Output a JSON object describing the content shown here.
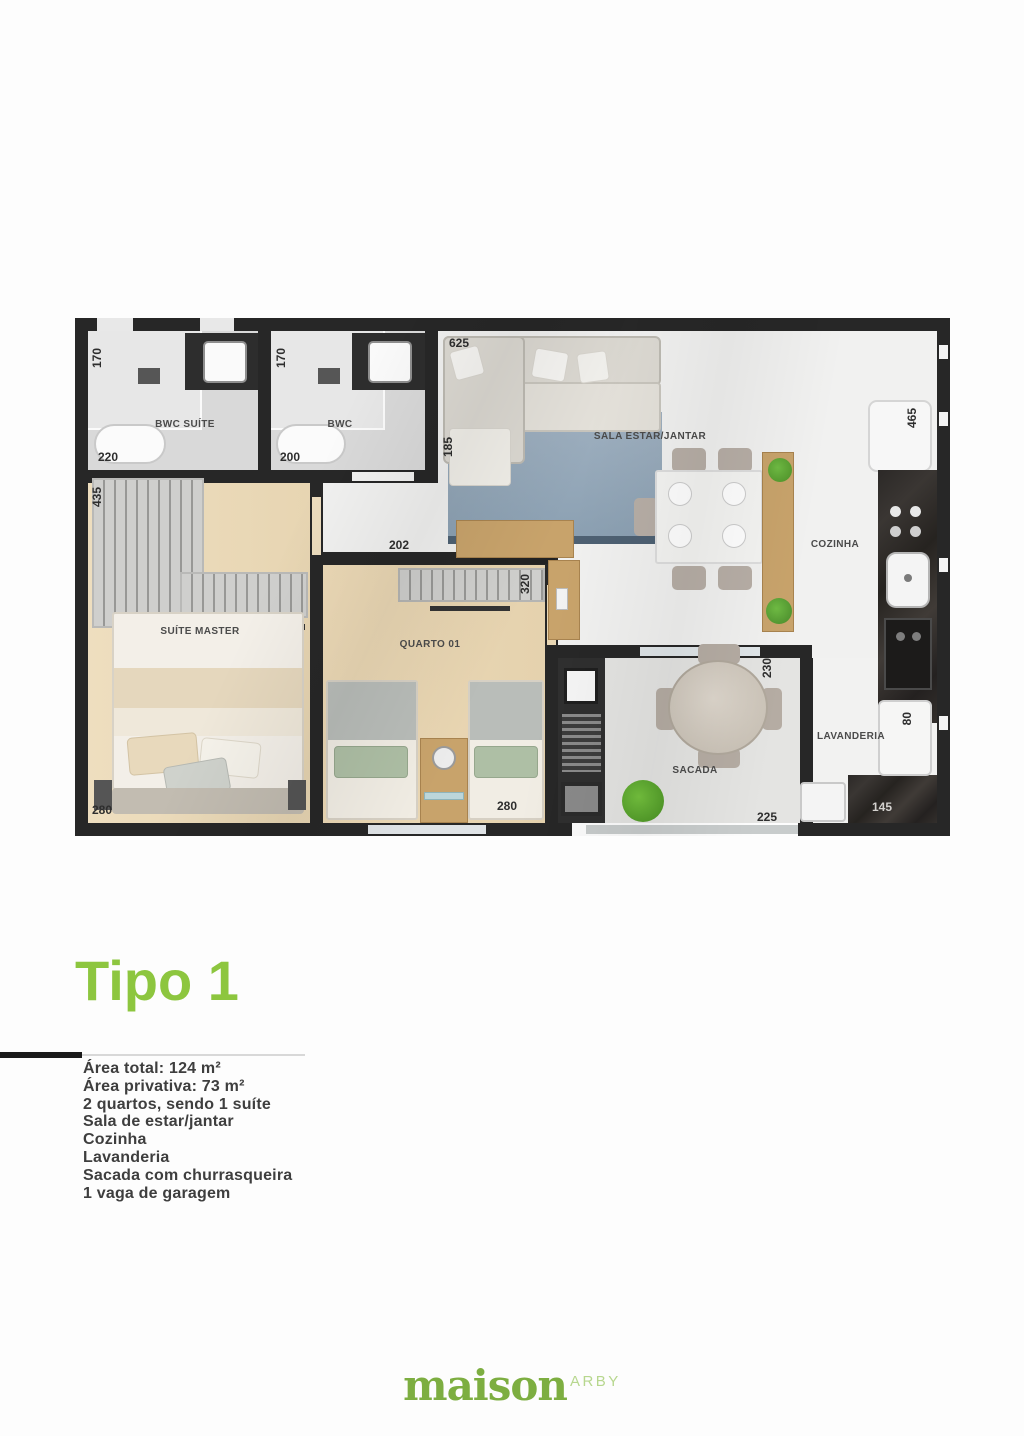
{
  "accent_green": "#8dc63f",
  "plan": {
    "labels": {
      "bwc_suite": "BWC SUÍTE",
      "bwc": "BWC",
      "sala": "SALA ESTAR/JANTAR",
      "cozinha": "COZINHA",
      "suite_master": "SUÍTE MASTER",
      "quarto01": "QUARTO 01",
      "sacada": "SACADA",
      "lavanderia": "LAVANDERIA"
    },
    "dims": {
      "bwc_suite_h": "170",
      "bwc_suite_w": "220",
      "bwc_h": "170",
      "bwc_w": "200",
      "sala_w": "625",
      "sala_h": "185",
      "cozinha_h": "465",
      "suite_h": "435",
      "suite_w": "280",
      "quarto_w_top": "202",
      "quarto_h": "320",
      "quarto_w": "280",
      "sacada_h": "230",
      "sacada_w": "225",
      "lavanderia_h": "80",
      "lavanderia_w": "145"
    }
  },
  "title": "Tipo 1",
  "details": [
    "Área total: 124 m²",
    "Área privativa: 73 m²",
    "2 quartos, sendo 1 suíte",
    "Sala de estar/jantar",
    "Cozinha",
    "Lavanderia",
    "Sacada com churrasqueira",
    "1 vaga de garagem"
  ],
  "footer": {
    "brand": "maison",
    "brand_suffix": "ARBY"
  }
}
